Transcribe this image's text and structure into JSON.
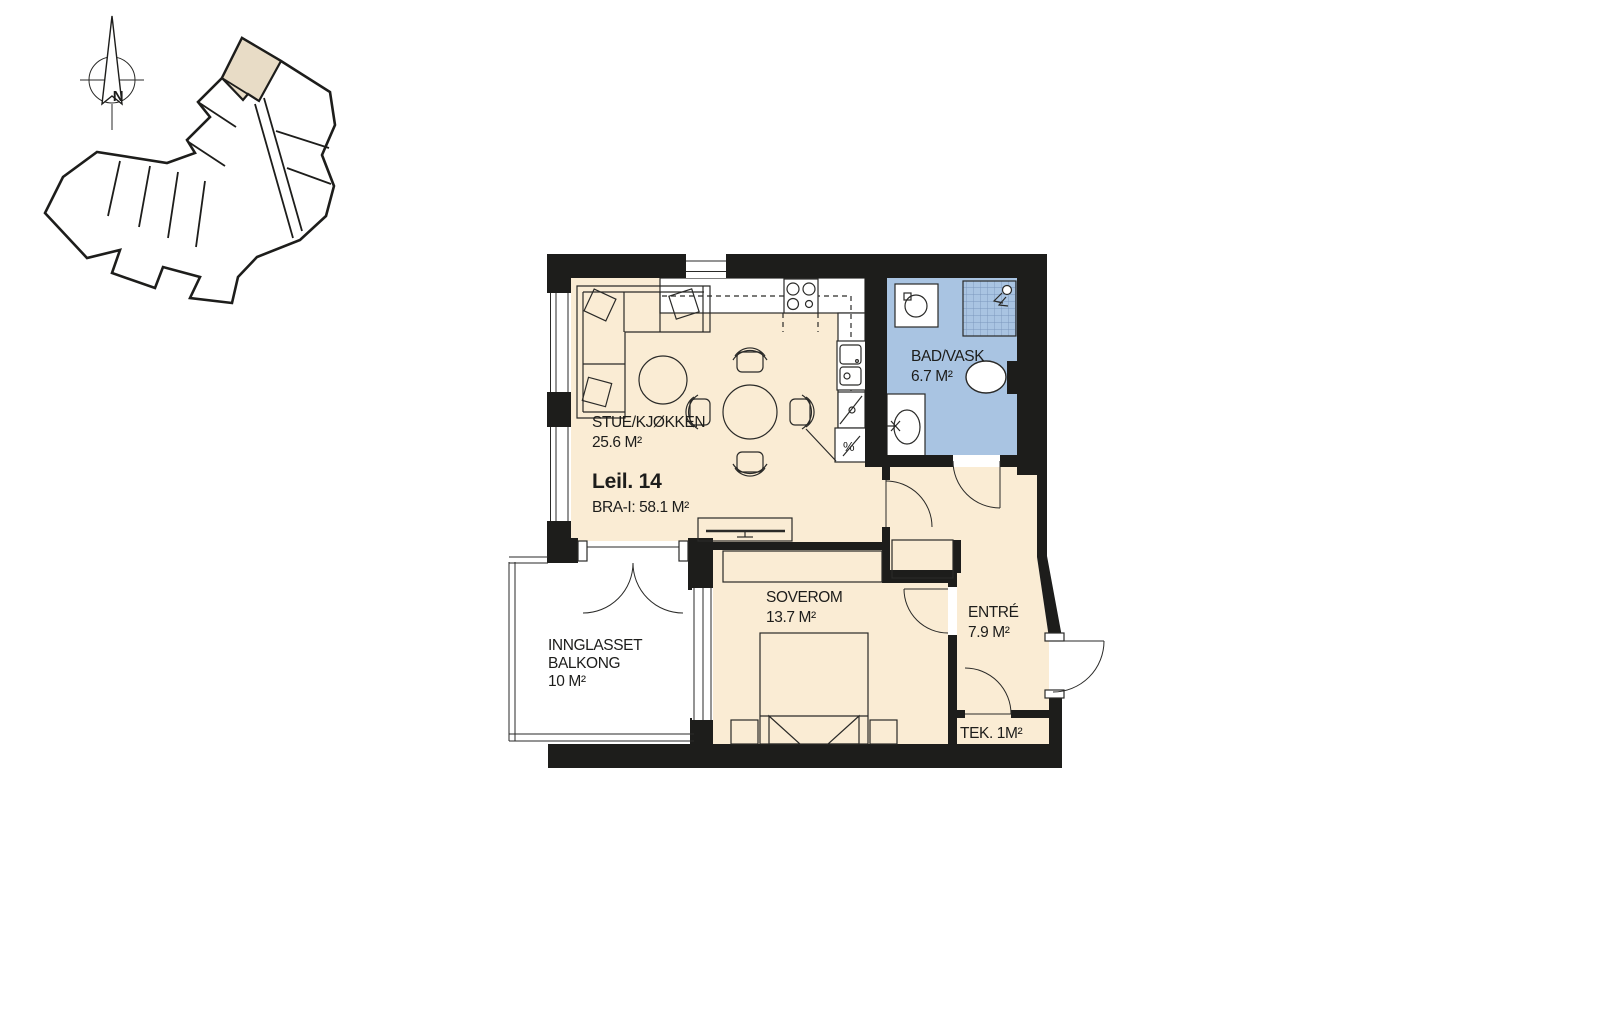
{
  "site_plan": {
    "north_label": "N"
  },
  "floor_plan": {
    "unit_title": "Leil. 14",
    "unit_area": "BRA-I: 58.1 M²",
    "rooms": {
      "living_kitchen": {
        "name": "STUE/KJØKKEN",
        "area": "25.6 M²"
      },
      "bathroom": {
        "name": "BAD/VASK",
        "area": "6.7 M²"
      },
      "bedroom": {
        "name": "SOVEROM",
        "area": "13.7 M²"
      },
      "entry": {
        "name": "ENTRÉ",
        "area": "7.9 M²"
      },
      "tech": {
        "label": "TEK. 1M²"
      },
      "balcony": {
        "name_line1": "INNGLASSET",
        "name_line2": "BALKONG",
        "area": "10 M²"
      }
    },
    "symbols": {
      "kitchen_appliance": "%"
    }
  },
  "colors": {
    "wall": "#1d1d1b",
    "floor": "#faecd4",
    "bathroom_floor": "#a9c4e2",
    "shower_grid": "#7c97bd",
    "highlighted_unit": "#e8dcc6",
    "background": "#ffffff"
  }
}
